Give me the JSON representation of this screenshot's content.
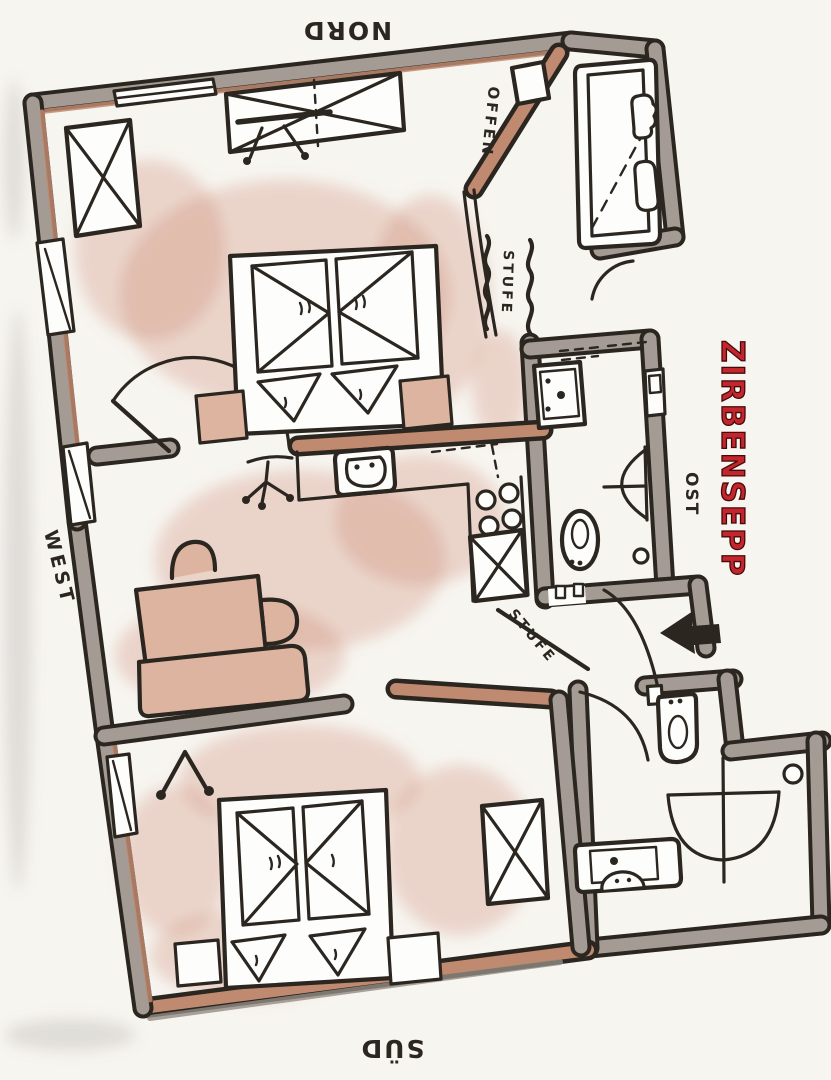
{
  "title": {
    "text": "ZIRBENSEPP",
    "color": "#c3262c"
  },
  "compass": {
    "north": "NORD",
    "south": "SÜD",
    "east": "OST",
    "west": "WEST"
  },
  "annotations": {
    "open_wall": "OFFEN",
    "step_upper": "STUFE",
    "step_lower": "STUFE"
  },
  "palette": {
    "ink": "#2b2620",
    "paper": "#f7f5f0",
    "wall_gray": "#a49c94",
    "wall_tan": "#c08a70",
    "wood": "#dcb4a0",
    "shade": "#c97f63",
    "title_red": "#c3262c"
  }
}
